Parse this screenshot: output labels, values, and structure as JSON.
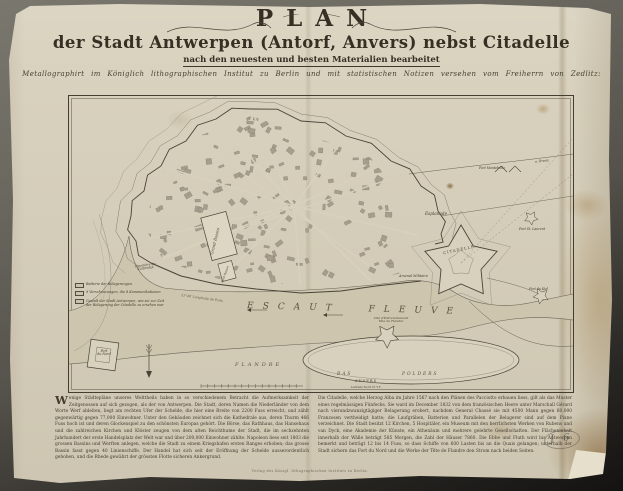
{
  "photo": {
    "backdrop_color": "#5d5a52",
    "paper_color": "#d8d1bd",
    "ink_color": "#3e382d"
  },
  "title_block": {
    "title": "PLAN",
    "subtitle": "der Stadt Antwerpen (Antorf, Anvers) nebst Citadelle",
    "edition_line": "nach den neuesten und besten Materialien bearbeitet",
    "imprint_line": "Metallographirt im Königlich lithographischen Institut zu Berlin und mit statistischen Notizen versehen vom Freiherrn von Zedlitz:"
  },
  "map": {
    "labels": {
      "river": "ESCAUT FLEUVE",
      "river_note": "21°48′ Longitude de Paris",
      "citadel": "CITADELLE",
      "esplanade": "Esplanade",
      "arsenal": "Arsenal Militaire",
      "grand_bassin": "Grand Bassin",
      "petit_bassin": "Petit Bassin",
      "cimetiere_line1": "Cimetière du",
      "cimetiere_line2": "Kattendyk",
      "fort_du_nord_line1": "Fort",
      "fort_du_nord_line2": "du Nord",
      "fort_montebello": "Fort Montebello",
      "fort_st_laurent": "Fort St. Laurent",
      "fort_du_kiel": "Fort du Kiel",
      "entrenchement_line1": "Cité d'Entrenchement",
      "entrenchement_line2": "Tête de Flandre",
      "flandre": "FLANDRE",
      "bas": "BAS",
      "polders": "POLDERS",
      "road_breda": "n. Breda",
      "anvers": "ANVERS",
      "anvers_note": "Latitude Nord 51°13′"
    },
    "legend": {
      "items": [
        "Batterie der Belagerungen",
        "9 Verschanzungen, die 8 Kommunikationen",
        "Gestalt der Stadt Antwerpen, wie sie zur Zeit der Belagerung der Citadelle zu ersehen war"
      ]
    }
  },
  "notes": {
    "drop_cap": "W",
    "column1": "enige Städtepläne unseres Welttheils haben in so verschiedenem Betracht die Aufmerksamkeit der Zeitgenossen auf sich gezogen, als der von Antwerpen. Die Stadt, deren Namen die Niederländer von dem Worte Werf ableiten, liegt am rechten Ufer der Schelde, die hier eine Breite von 2200 Fuss erreicht, und zählt gegenwärtig gegen 77,000 Einwohner. Unter den Gebäuden zeichnet sich die Kathedrale aus, deren Thurm 466 Fuss hoch ist und deren Glockenspiel zu den schönsten Europas gehört. Die Börse, das Rathhaus, das Hansehaus und die zahlreichen Kirchen und Klöster zeugen von dem alten Reichthume der Stadt, die im sechzehnten Jahrhundert der erste Handelsplatz der Welt war und über 200,000 Einwohner zählte. Napoleon liess seit 1803 die grossen Bassins und Werften anlegen, welche die Stadt zu einem Kriegshafen ersten Ranges erhoben; das grosse Bassin fasst gegen 40 Linienschiffe. Der Handel hat sich seit der Eröffnung der Schelde ausserordentlich gehoben, und die Rhede gewährt der grössten Flotte sicheren Ankergrund.",
    "column2": "Die Citadelle, welche Herzog Alba im Jahre 1567 nach den Plänen des Pacciotto erbauen liess, gilt als das Muster eines regelmässigen Fünfecks. Sie ward im December 1832 von dem französischen Heere unter Marschall Gérard nach vierundzwanzigtägiger Belagerung erobert, nachdem General Chassé sie mit 4500 Mann gegen 60,000 Franzosen vertheidigt hatte; die Laufgräben, Batterien und Parallelen der Belagerer sind auf dem Plane verzeichnet. Die Stadt besitzt 12 Kirchen, 5 Hospitäler, ein Museum mit den herrlichsten Werken von Rubens und van Dyck, eine Akademie der Künste, ein Athenäum und mehrere gelehrte Gesellschaften. Der Flächeninhalt innerhalb der Wälle beträgt 585 Morgen, die Zahl der Häuser 7860. Die Ebbe und Fluth wird bis Antwerpen bemerkt und beträgt 12 bis 14 Fuss, so dass Schiffe von 600 Lasten bis an die Quais gelangen; unterhalb der Stadt sichern das Fort du Nord und die Werke der Tête de Flandre den Strom nach beiden Seiten."
  },
  "publisher_line": "Verlag des Königl. lithographischen Instituts zu Berlin.",
  "pencil_mark": "J 6"
}
